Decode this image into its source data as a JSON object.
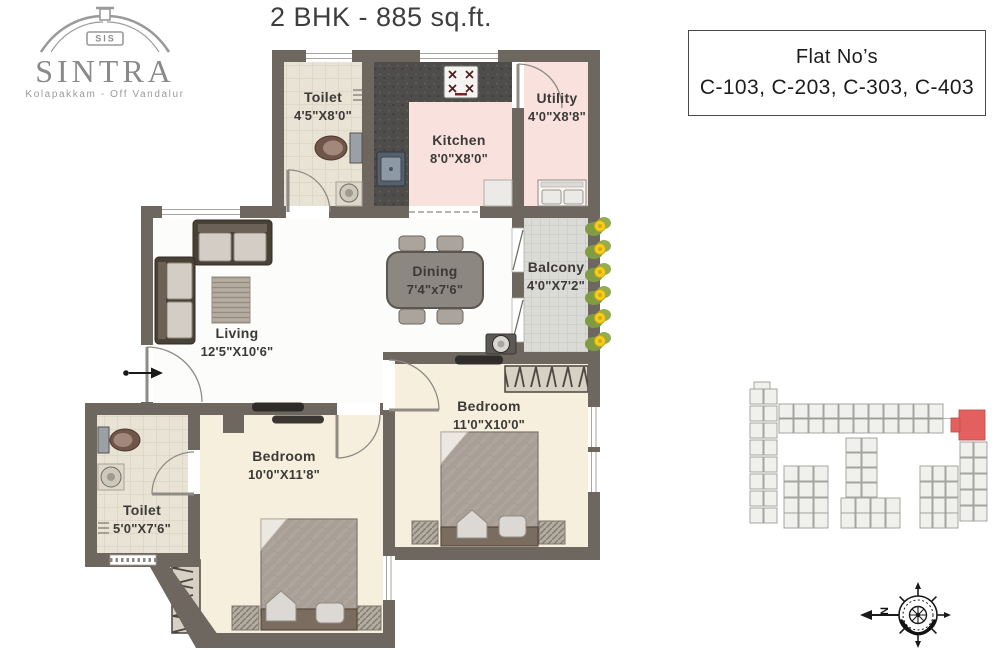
{
  "header": {
    "logo": {
      "brand": "SINTRA",
      "sub": "Kolapakkam - Off Vandalur",
      "emblem": "SIS"
    },
    "title": "2 BHK - 885 sq.ft."
  },
  "flat_box": {
    "heading": "Flat No’s",
    "numbers": "C-103,  C-203,  C-303,  C-403"
  },
  "floorplan": {
    "rooms": [
      {
        "id": "toilet-top",
        "name": "Toilet",
        "dims": "4'5\"X8'0\""
      },
      {
        "id": "kitchen",
        "name": "Kitchen",
        "dims": "8'0\"X8'0\""
      },
      {
        "id": "utility",
        "name": "Utility",
        "dims": "4'0\"X8'8\""
      },
      {
        "id": "living",
        "name": "Living",
        "dims": "12'5\"X10'6\""
      },
      {
        "id": "dining",
        "name": "Dining",
        "dims": "7'4\"x7'6\""
      },
      {
        "id": "balcony",
        "name": "Balcony",
        "dims": "4'0\"X7'2\""
      },
      {
        "id": "bedroom-right",
        "name": "Bedroom",
        "dims": "11'0\"X10'0\""
      },
      {
        "id": "bedroom-left",
        "name": "Bedroom",
        "dims": "10'0\"X11'8\""
      },
      {
        "id": "toilet-bottom",
        "name": "Toilet",
        "dims": "5'0\"X7'6\""
      }
    ],
    "compass": {
      "north_label": "N"
    }
  },
  "colors": {
    "wall": "#6e6760",
    "kitchen_floor": "#f9e2de",
    "bedroom_floor": "#f7efdd",
    "toilet_tile": "#e8e3d5",
    "balcony_tile": "#dadad6",
    "keyplan_highlight": "#e4605f",
    "logo_gray": "#8a8a8a"
  }
}
